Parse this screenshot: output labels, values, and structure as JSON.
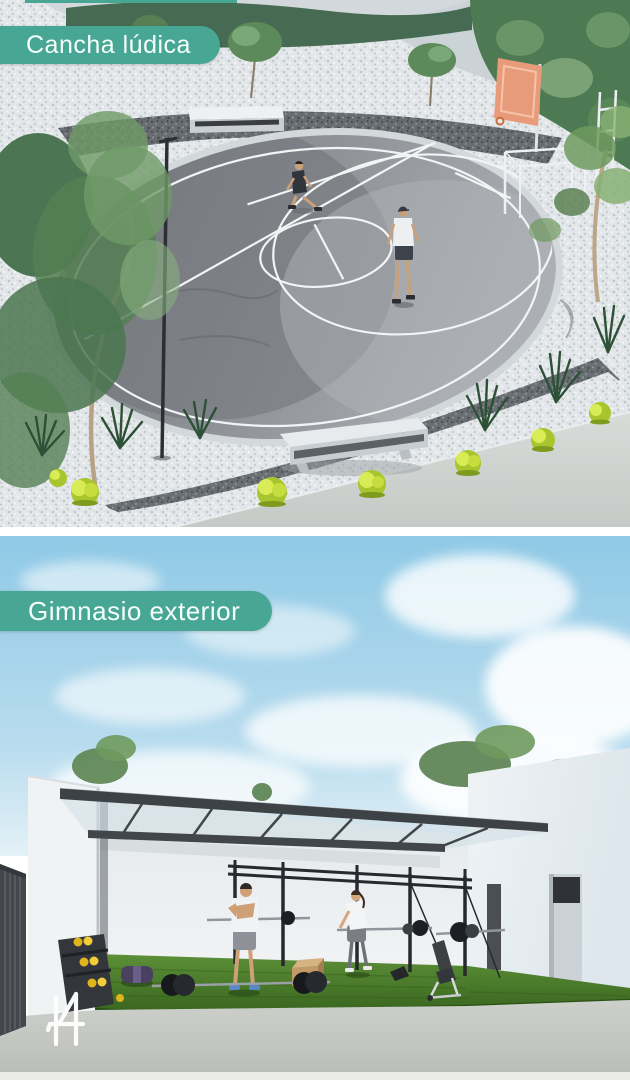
{
  "theme": {
    "badge_background": "#48a695",
    "badge_text_color": "#f5fffc",
    "page_background": "#ffffff"
  },
  "panels": [
    {
      "label": "Cancha lúdica",
      "scene": "Aerial 3D render of a grey rounded court with white markings, two players, basketball hoop with salmon backboard, white mini goal, concrete benches, white gravel beds, spiky plants, yellow-green shrubs and trees"
    },
    {
      "label": "Gimnasio exterior",
      "scene": "3D render of an outdoor gym on artificial turf under a slanted steel canopy: black training rig, barbells, yellow dumbbell rack, wooden plyo box, incline bench, man stretching and woman exercising beside white walls"
    }
  ],
  "logo": {
    "mark": "I4"
  }
}
